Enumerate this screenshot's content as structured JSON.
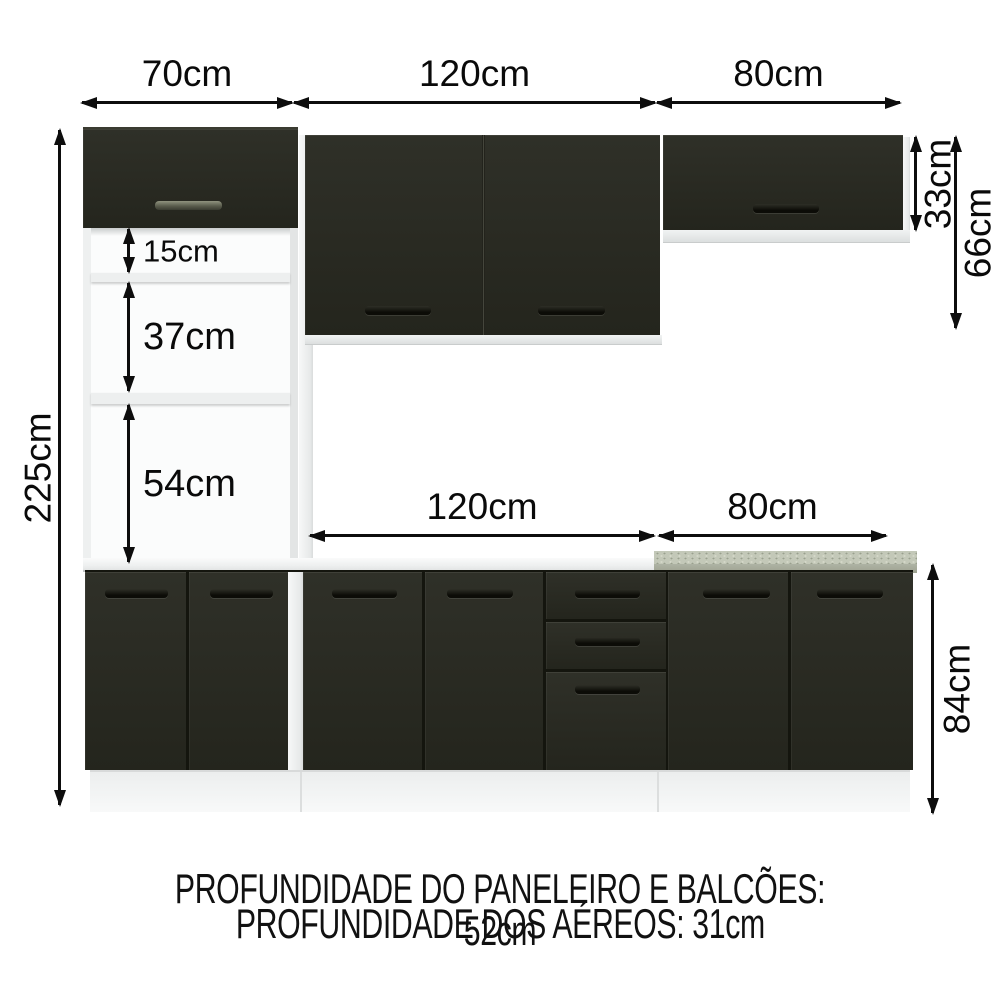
{
  "page": {
    "description": "Kitchen modular cabinet set dimension diagram (paneleiro, wall cabinets and base cabinets) on white background"
  },
  "dims": {
    "top_70": "70cm",
    "top_120": "120cm",
    "top_80": "80cm",
    "left_225": "225cm",
    "shelf_15": "15cm",
    "shelf_37": "37cm",
    "shelf_54": "54cm",
    "right_33": "33cm",
    "right_66": "66cm",
    "mid_120": "120cm",
    "mid_80": "80cm",
    "right_84": "84cm"
  },
  "footer": {
    "line1": "PROFUNDIDADE DO PANELEIRO E BALCÕES: 52cm",
    "line2": "PROFUNDIDADE DOS AÉREOS: 31cm"
  },
  "colors": {
    "door_black": "#2a2b23",
    "handle_dark": "#10100a",
    "handle_light": "#5c5f51",
    "structure_white": "#f2f3f3",
    "countertop_granite_top": "#c3c8b8",
    "countertop_granite_edge": "#a5aa9b",
    "arrow_ink": "#0d0d0d",
    "background": "#ffffff"
  }
}
